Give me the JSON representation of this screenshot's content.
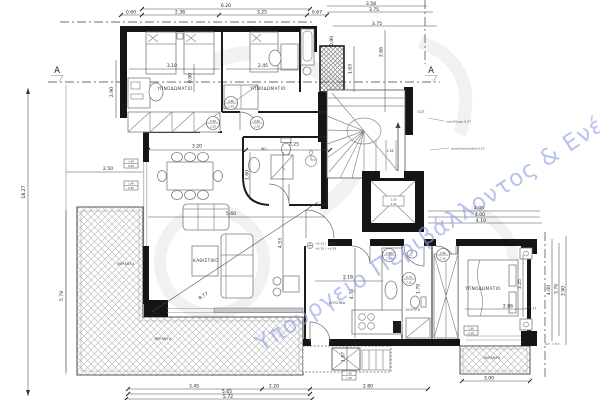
{
  "watermark": "Υπουργείο Περιβάλλοντος & Ενέργειας",
  "section_marker": "A",
  "rooms": {
    "bedroom1": "ΥΠΝΟΔΩΜΑΤΙΟ",
    "bedroom2": "ΥΠΝΟΔΩΜΑΤΙΟ",
    "bedroom3": "ΥΠΝΟΔΩΜΑΤΙΟ",
    "living": "ΚΑΘΙΣΤΙΚΟ",
    "kitchen": "ΚΟΥΖΙΝΑ",
    "bathroom": "ΛΟΥΤΡΟ",
    "wc": "WC",
    "veranda_left": "ΒΕΡΑΝΤΑ",
    "veranda_bottom": "ΒΕΡΑΝΤΑ",
    "veranda_right": "ΒΕΡΑΝΤΑ"
  },
  "dims": {
    "top": [
      "6.20",
      "0.60",
      "2.38",
      "3.25",
      "0.67",
      "3.58",
      "3.75",
      "3.75"
    ],
    "left": [
      "18.27",
      "2.90",
      "2.50",
      "5.79"
    ],
    "bottom": [
      "3.45",
      "2.20",
      "2.80",
      "5.65",
      "5.72",
      "3.00"
    ],
    "right": [
      "4.00",
      "4.00",
      "4.10",
      "4.00",
      "3.76",
      "3.90",
      "0.17"
    ],
    "interior": [
      "3.10",
      "0.90",
      "2.45",
      "0.90",
      "1.63",
      "2.66",
      "3.20",
      "3.25",
      "1.60",
      "5.60",
      "4.53",
      "8.77",
      "2.18",
      "4.73",
      "1.70",
      "2.86",
      "3.25",
      "1.67",
      "0.27",
      "1.36"
    ]
  },
  "annotations": {
    "boundary_line": "Ο.Γ. = Ρ.Γ.",
    "level_1": "+6.15 / +6.25",
    "level_2": "+6.10 / +6.28",
    "stair_note_1": "κιγκλίδωμα 0.07",
    "stair_note_2": "μεταλλική σκάλα 0.10"
  },
  "tags": {
    "doors": [
      {
        "w": "0.90",
        "h": "2.20"
      },
      {
        "w": "0.90",
        "h": "2.20"
      },
      {
        "w": "0.90",
        "h": "2.20"
      },
      {
        "w": "0.90",
        "h": "2.10"
      },
      {
        "w": "0.75",
        "h": "2.10"
      },
      {
        "w": "0.90",
        "h": "2.10"
      }
    ],
    "windows": [
      {
        "w": "1.40",
        "h": "0.90"
      },
      {
        "w": "1.40",
        "h": "0.90"
      },
      {
        "w": "1.40",
        "h": "1.10"
      },
      {
        "w": "1.60",
        "h": "1.10"
      }
    ],
    "elevator": {
      "w": "1.20",
      "h": "2.20"
    }
  }
}
